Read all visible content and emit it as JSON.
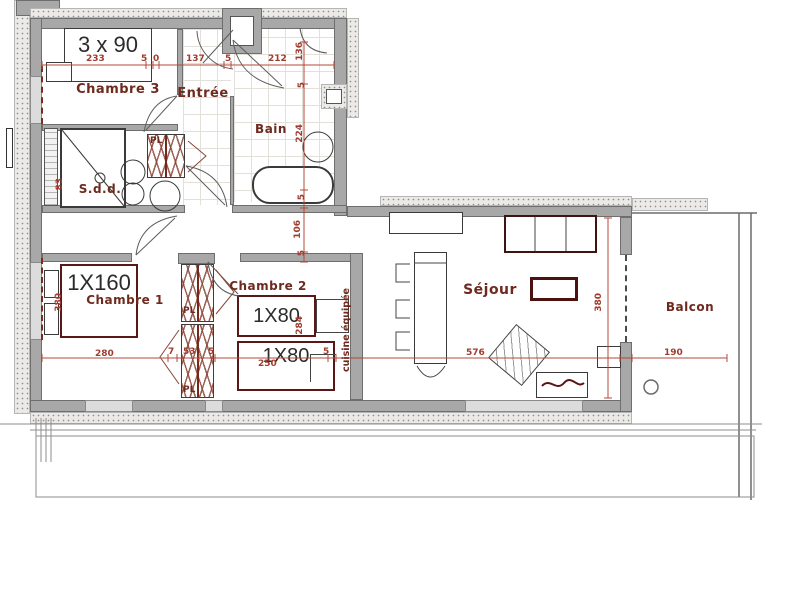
{
  "labels": {
    "chambre3": "Chambre 3",
    "entree": "Entrée",
    "bain": "Bain",
    "sdd": "S.d.d.",
    "chambre1": "Chambre 1",
    "chambre2": "Chambre 2",
    "sejour": "Séjour",
    "balcon": "Balcon",
    "cuisine": "cuisine équipée",
    "placard": "PL"
  },
  "furniture": {
    "bed_c3": "3 x 90",
    "bed_c1": "1X160",
    "bed_c2a": "1X80",
    "bed_c2b": "1X80"
  },
  "dims": {
    "c3_width": "233",
    "seg_a": "5",
    "seg_b": "0",
    "entree_width": "137",
    "seg_c": "5",
    "bain_width": "212",
    "bain_recess": "136",
    "bain_seg_a": "5",
    "bain_depth": "224",
    "bain_seg_b": "5",
    "corridor": "106",
    "corridor_seg": "5",
    "shower": "83",
    "c1_height": "380",
    "c1_width": "280",
    "closet_a": "7",
    "closet_b": "53",
    "closet_c": "5",
    "c2_width": "250",
    "c2_seg": "5",
    "c2_depth": "284",
    "sejour_width": "576",
    "sejour_depth": "380",
    "balcon_width": "190"
  },
  "colors": {
    "wall": "#a8a8a8",
    "dimension_line": "#a03c2e",
    "room_label": "#6e2a1e",
    "bed_outline": "#5a1717"
  }
}
